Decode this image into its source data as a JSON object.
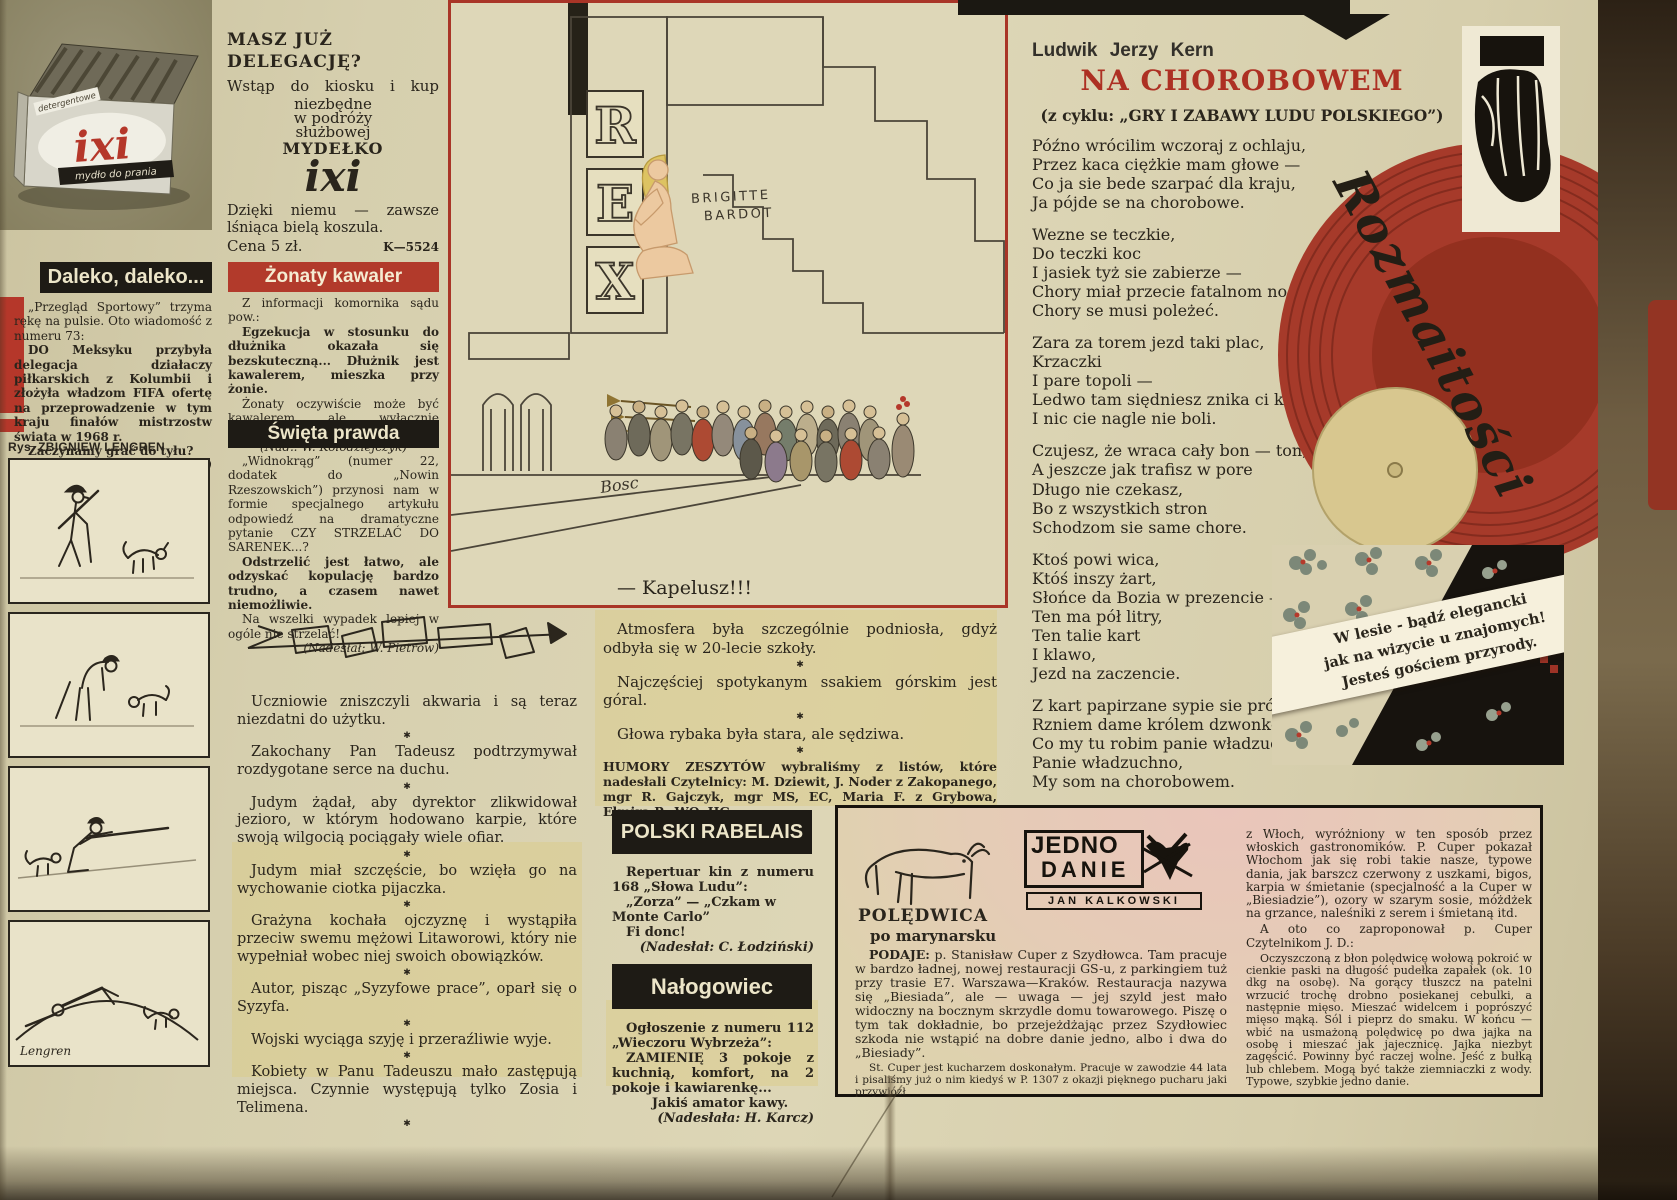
{
  "sep": "✱",
  "ixi_box": {
    "label_top": "detergentowe",
    "brand": "ixi",
    "label_bottom": "mydło do prania"
  },
  "daleko": {
    "title": "Daleko, daleko...",
    "p1": "„Przegląd Sportowy” trzyma rękę na pulsie. Oto wiadomość z numeru 73:",
    "p2": "DO Meksyku przybyła delegacja działaczy piłkarskich z Kolumbii i złożyła władzom FIFA ofertę na przeprowadzenie w tym kraju finałów mistrzostw świata w 1968 r.",
    "p3": "Zaczynamy grać do tyłu?",
    "credit": "(Nadesłał: J. Tuna)"
  },
  "lengren": {
    "credit": "Rys. ZBIGNIEW LENGREN",
    "signature": "Lengren"
  },
  "mydelko": {
    "l1": "MASZ JUŻ",
    "l2": "DELEGACJĘ?",
    "l3": "Wstąp do kiosku i kup",
    "l4": "niezbędne",
    "l5": "w podróży",
    "l6": "służbowej",
    "l7": "MYDEŁKO",
    "brand": "ixi",
    "tagline": "Dzięki niemu — zawsze lśniąca bielą koszula.",
    "price": "Cena 5 zł.",
    "code": "K—5524"
  },
  "zonaty": {
    "title": "Żonaty kawaler",
    "p1": "Z informacji komornika sądu pow.:",
    "p2": "Egzekucja w stosunku do dłużnika okazała się bezskuteczną... Dłużnik jest kawalerem, mieszka przy żonie.",
    "p3": "Żonaty oczywiście może być kawalerem ale wyłącznie kawalerem orderu.",
    "credit": "(Nad.: W. Kołodziejczyk)"
  },
  "swieta": {
    "title": "Święta prawda",
    "p1": "„Widnokrąg” (numer 22, dodatek do „Nowin Rzeszowskich”) przynosi nam w formie specjalnego artykułu odpowiedź na dramatyczne pytanie CZY STRZELAĆ DO SARENEK...?",
    "p2": "Odstrzelić jest łatwo, ale odzyskać kopulację bardzo trudno, a czasem nawet niemożliwie.",
    "p3": "Na wszelki wypadek lepiej w ogóle nie strzelać!",
    "credit": "(Nadesłał: W. Pietrow)"
  },
  "cartoon": {
    "rex": [
      "R",
      "E",
      "X"
    ],
    "sign1": "BRIGITTE",
    "sign2": "BARDOT",
    "artist": "Bosc",
    "caption": "— Kapelusz!!!"
  },
  "jokes_left": [
    "Uczniowie zniszczyli akwaria i są teraz niezdatni do użytku.",
    "Zakochany Pan Tadeusz podtrzymywał rozdygotane serce na duchu.",
    "Judym żądał, aby dyrektor zlikwidował jezioro, w którym hodowano karpie, które swoją wilgocią pociągały wiele ofiar.",
    "Judym miał szczęście, bo wzięła go na wychowanie ciotka pijaczka.",
    "Grażyna kochała ojczyznę i wystąpiła przeciw swemu mężowi Litaworowi, który nie wypełniał wobec niej swoich obowiązków.",
    "Autor, pisząc „Syzyfowe prace”, oparł się o Syzyfa.",
    "Wojski wyciąga szyję i przeraźliwie wyje.",
    "Kobiety w Panu Tadeuszu mało zastępują miejsca. Czynnie występują tylko Zosia i Telimena."
  ],
  "jokes_right": [
    "Atmosfera była szczególnie podniosła, gdyż odbyła się w 20-lecie szkoły.",
    "Najczęściej spotykanym ssakiem górskim jest góral.",
    "Głowa rybaka była stara, ale sędziwa."
  ],
  "humory": {
    "lead": "HUMORY ZESZYTÓW",
    "rest": "wybraliśmy z listów, które nadesłali Czytelnicy: M. Dziewit, J. Noder z Zakopanego, mgr R. Gajczyk, mgr MS, EC, Maria F. z Grybowa, Elmira P., WO, HG.",
    "thanks": "Dziękujemy."
  },
  "rabelais": {
    "title": "POLSKI RABELAIS",
    "p1": "Repertuar kin z numeru 168 „Słowa Ludu”:",
    "p2": "„Zorza” — „Czkam w Monte Carlo”",
    "p3": "Fi donc!",
    "credit": "(Nadesłał: C. Łodziński)"
  },
  "nalogowiec": {
    "title": "Nałogowiec",
    "p1": "Ogłoszenie z numeru 112 „Wieczoru Wybrzeża”:",
    "p2": "ZAMIENIĘ 3 pokoje z kuchnią, komfort, na 2 pokoje i kawiarenkę...",
    "p3": "Jakiś amator kawy.",
    "credit": "(Nadesłała: H. Karcz)"
  },
  "poem": {
    "author": "Ludwik Jerzy Kern",
    "title": "NA CHOROBOWEM",
    "subtitle": "(z cyklu: „GRY I ZABAWY LUDU POLSKIEGO”)",
    "stanzas": [
      "Późno wrócilim wczoraj z ochlaju,\nPrzez kaca ciężkie mam głowe —\nCo ja sie bede szarpać dla kraju,\nJa pójde se na chorobowe.",
      "Wezne se teczkie,\nDo teczki koc\nI jasiek tyż sie zabierze —\nChory miał przecie fatalnom noc,\nChory se musi poleżeć.",
      "Zara za torem jezd taki plac,\nKrzaczki\nI pare topoli —\nLedwo tam siędniesz znika ci kac\nI nic cie nagle nie boli.",
      "Czujesz, że wraca cały bon — ton,\nA jeszcze jak trafisz w pore\nDługo nie czekasz,\nBo z wszystkich stron\nSchodzom sie same chore.",
      "Ktoś powi wica,\nKtóś inszy żart,\nSłońce da Bozia w prezencie —\nTen ma pół litry,\nTen talie kart\nI klawo,\nJezd na zaczencie.",
      "Z kart papirzane sypie sie próchno,\nRzniem dame królem dzwonkowem —\nCo my tu robim panie władzuchno?\nPanie władzuchno,\nMy som na chorobowem."
    ]
  },
  "script_title": "Rozmaitości",
  "forest": {
    "line1": "W lesie - bądź elegancki",
    "line2": "jak na wizycie u znajomych!",
    "line3": "Jesteś gościem przyrody."
  },
  "recipe": {
    "logo_line1": "JEDNO",
    "logo_line2": "DANIE",
    "logo_author": "JAN KALKOWSKI",
    "title": "POLĘDWICA",
    "subtitle": "po marynarsku",
    "lead": "PODAJE:",
    "p1": "p. Stanisław Cuper z Szydłowca. Tam pracuje w bardzo ładnej, nowej restauracji GS-u, z parkingiem tuż przy trasie E7. Warszawa—Kraków. Restauracja nazywa się „Biesiada”, ale — uwaga — jej szyld jest mało widoczny na bocznym skrzydle domu towarowego. Piszę o tym tak dokładnie, bo przejeżdżając przez Szydłowiec szkoda nie wstąpić na dobre danie jedno, albo i dwa do „Biesiady”.",
    "p2": "St. Cuper jest kucharzem doskonałym. Pracuje w zawodzie 44 lata i pisaliśmy już o nim kiedyś w P. 1307 z okazji pięknego pucharu jaki przywiózł",
    "p3": "z Włoch, wyróżniony w ten sposób przez włoskich gastronomików. P. Cuper pokazał Włochom jak się robi takie nasze, typowe dania, jak barszcz czerwony z uszkami, bigos, karpia w śmietanie (specjalność a la Cuper w „Biesiadzie”), ozory w szarym sosie, móżdżek na grzance, naleśniki z serem i śmietaną itd.",
    "p4": "A oto co zaproponował p. Cuper Czytelnikom J. D.:",
    "p5": "Oczyszczoną z błon polędwicę wołową pokroić w cienkie paski na długość pudełka zapałek (ok. 10 dkg na osobę). Na gorący tłuszcz na patelni wrzucić trochę drobno posiekanej cebulki, a następnie mięso. Mieszać widelcem i poprószyć mięso mąką. Sól i pieprz do smaku. W końcu — wbić na usmażoną polędwicę po dwa jajka na osobę i mieszać jak jajecznicę. Jajka niezbyt zagęścić. Powinny być raczej wolne. Jeść z bułką lub chlebem. Mogą być także ziemniaczki z wody. Typowe, szybkie jedno danie."
  }
}
